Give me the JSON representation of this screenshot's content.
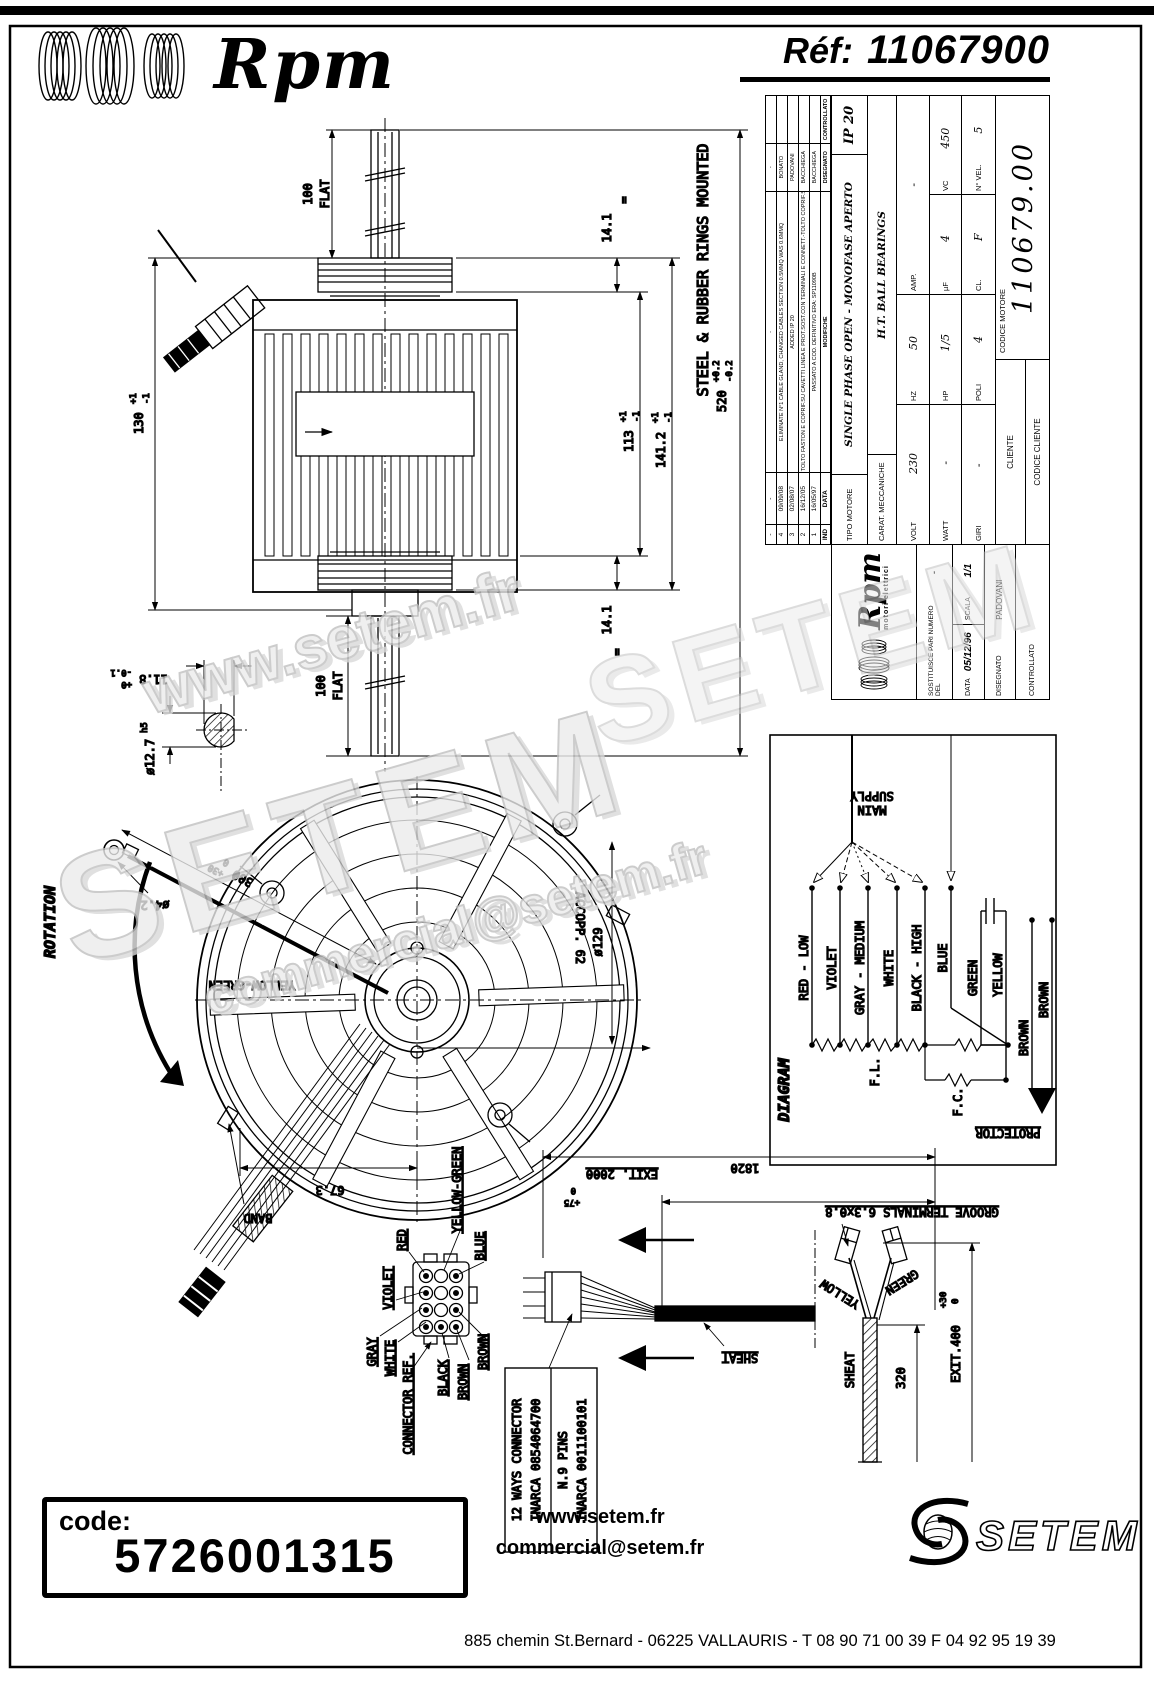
{
  "colors": {
    "line": "#000000",
    "background": "#ffffff",
    "watermark": "#c8c8c8"
  },
  "header": {
    "brand": "Rpm",
    "ref_label": "Réf:",
    "ref_value": "11067900"
  },
  "watermarks": {
    "w1": "www.setem.fr",
    "w2": "SETEM",
    "w3": "commercial@setem.fr",
    "w4": "SETEM"
  },
  "side_view": {
    "note": "STEEL & RUBBER RINGS MOUNTED",
    "dim_100": "100",
    "flat": "FLAT",
    "dim_130": "130",
    "tol_p1": "+1",
    "tol_m1": "-1",
    "dim_141": "14.1",
    "dim_113": "113",
    "dim_1412": "141.2",
    "dim_520": "520",
    "tol_p02": "+0.2",
    "tol_m02": "-0.2",
    "equals": "=",
    "shaft_detail": {
      "dim_118": "11.8",
      "tol_p0": "+0",
      "tol_m01": "-0.1",
      "dim_d127": "ø12.7",
      "fit": "h5"
    }
  },
  "front_view": {
    "rotation": "ROTATION",
    "dim_300": "300",
    "tol_p30": "+30",
    "tol_0": "0",
    "dim_d42": "ø4.2",
    "ground_label": "YELLOW-GREEN",
    "band": "BAND",
    "dim_673": "67.3",
    "accopp": "ACCOPP. 62",
    "dim_d129": "ø129"
  },
  "wiring": {
    "title": "DIAGRAM",
    "main_line1": "MAIN",
    "main_line2": "SUPPLY",
    "wire_red": "RED - LOW",
    "wire_violet": "VIOLET",
    "wire_gray": "GRAY - MEDIUM",
    "wire_white": "WHITE",
    "wire_black": "BLACK - HIGH",
    "wire_blue": "BLUE",
    "wire_green": "GREEN",
    "wire_yellow": "YELLOW",
    "wire_brown1": "BROWN",
    "wire_brown2": "BROWN",
    "fl": "F.L.",
    "fc": "F.C.",
    "protector": "PROTECTOR"
  },
  "connector": {
    "pin_red": "RED",
    "pin_yellow_green": "YELLOW-GREEN",
    "pin_blue": "BLUE",
    "pin_violet": "VIOLET",
    "pin_gray": "GRAY",
    "pin_white": "WHITE",
    "pin_black": "BLACK",
    "pin_brown1": "BROWN",
    "pin_brown2": "BROWN",
    "ref_label": "CONNECTOR REF.",
    "box_line1": "12 WAYS CONNECTOR",
    "box_line2": "INARCA 0854064700",
    "box_line3": "N.9 PINS",
    "box_line4": "INARCA 0011100101"
  },
  "cable": {
    "exit2000": "EXIT. 2000",
    "exit2000_sup": "+75",
    "exit2000_sub": "0",
    "dim_1820": "1820",
    "sheat_label1": "SHEAT",
    "groove": "GROOVE TERMINALS 6.3x0.8",
    "yellow": "YELLOW",
    "green": "GREEN",
    "sheat_label2": "SHEAT",
    "dim_320": "320",
    "exit400": "EXIT.400",
    "exit400_sup": "+30",
    "exit400_sub": "0"
  },
  "title_block": {
    "headers": {
      "ind": "IND",
      "data": "DATA",
      "modifiche": "MODIFICHE",
      "disegnato": "DISEGNATO",
      "controllato": "CONTROLLATO"
    },
    "revisions": [
      {
        "ind": "-",
        "date": "-",
        "text": "-",
        "name": "-"
      },
      {
        "ind": "4",
        "date": "09/09/08",
        "text": "ELIMINATE N°1 CABLE GLAND, CHANGED CABLES SECTION 0.5MMQ WAS 0.6MMQ",
        "name": "BONATO"
      },
      {
        "ind": "3",
        "date": "02/08/07",
        "text": "ADDED IP 20",
        "name": "PADOVANI"
      },
      {
        "ind": "2",
        "date": "16/12/05",
        "text": "TOLTO FASTON E COPRIF.SU CAVETTI LINEA E PROT.SOST.CON TERMINALI E CONNETT.-TOLTO COPRIF.SU CAVETTI COND.",
        "name": "BACCHIEGA"
      },
      {
        "ind": "1",
        "date": "16/05/97",
        "text": "PASSATO A COD. DEFINITIVO ERA: SP11090B",
        "name": "BACCHIEGA"
      }
    ],
    "tipo_label": "TIPO MOTORE",
    "tipo_value": "SINGLE PHASE OPEN - MONOFASE APERTO",
    "ip": "IP 20",
    "carat_label": "CARAT. MECCANICHE",
    "carat_value": "H.T. BALL BEARINGS",
    "volt_label": "VOLT",
    "volt_value": "230",
    "hz_label": "HZ",
    "hz_value": "50",
    "amp_label": "AMP.",
    "amp_value": "-",
    "watt_label": "WATT",
    "watt_value": "-",
    "hp_label": "HP",
    "hp_value": "1/5",
    "uf_label": "µF",
    "uf_value": "4",
    "vc_label": "VC",
    "vc_value": "450",
    "giri_label": "GIRI",
    "giri_value": "-",
    "poli_label": "POLI",
    "poli_value": "4",
    "cl_label": "CL.",
    "cl_value": "F",
    "nvel_label": "N° VEL.",
    "nvel_value": "5",
    "cliente": "CLIENTE",
    "codice_cliente": "CODICE CLIENTE",
    "codice_motore_label": "CODICE MOTORE",
    "codice_motore_value": "110679.00",
    "logo_brand": "Rpm",
    "logo_sub": "motori elettrici",
    "sostituisce_label": "SOSTITUISCE PARI NUMERO DEL",
    "sostituisce_value": "-",
    "data_label": "DATA",
    "data_value": "05/12/96",
    "scala_label": "SCALA",
    "scala_value": "1/1",
    "disegnato_label": "DISEGNATO",
    "disegnato_value": "PADOVANI",
    "controllato_label": "CONTROLLATO"
  },
  "footer": {
    "code_label": "code:",
    "code_value": "5726001315",
    "web": "www.setem.fr",
    "email": "commercial@setem.fr",
    "brand": "SETEM",
    "address": "885 chemin St.Bernard  -  06225 VALLAURIS  -  T 08 90 71 00 39   F 04 92 95 19 39"
  }
}
